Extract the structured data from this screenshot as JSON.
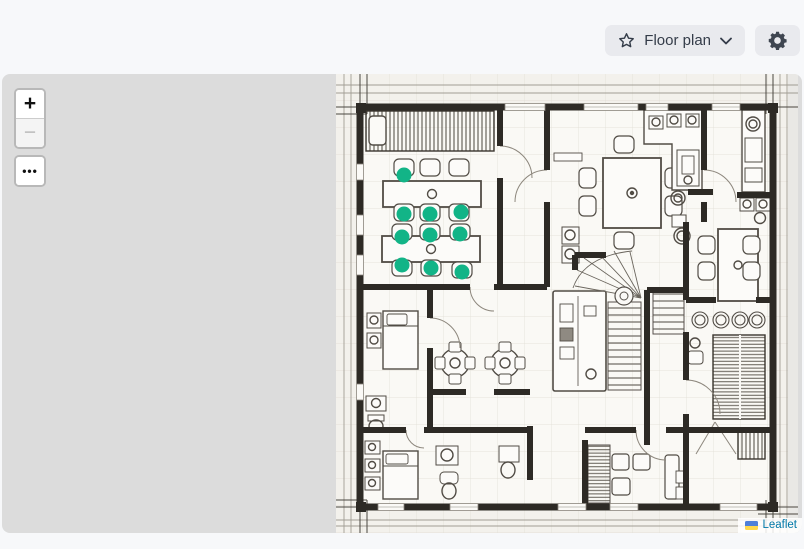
{
  "header": {
    "floor_plan_button": {
      "label": "Floor plan",
      "icons": [
        "star-outline-icon",
        "chevron-down-icon"
      ]
    },
    "settings_button": {
      "icon": "gear-icon"
    }
  },
  "map": {
    "controls": {
      "zoom_in": "+",
      "zoom_out": "−",
      "more": "•••"
    },
    "attribution": {
      "label": "Leaflet",
      "icon": "ukraine-flag-icon"
    },
    "layer_name": "Floor plan",
    "markers": [
      {
        "x": 68,
        "y": 101
      },
      {
        "x": 68,
        "y": 140
      },
      {
        "x": 94,
        "y": 140
      },
      {
        "x": 125,
        "y": 138
      },
      {
        "x": 66,
        "y": 163
      },
      {
        "x": 94,
        "y": 161
      },
      {
        "x": 124,
        "y": 160
      },
      {
        "x": 66,
        "y": 191
      },
      {
        "x": 95,
        "y": 194
      },
      {
        "x": 126,
        "y": 198
      }
    ]
  },
  "colors": {
    "marker": "#12b487",
    "leaflet_link": "#0078a8",
    "map_bg": "#dcdcdc",
    "wall": "#2d2a25",
    "paper": "#f3f1ec",
    "button_bg": "#e9eaee",
    "button_text": "#343c49",
    "flag_blue": "#4f80da",
    "flag_yellow": "#ffd84d"
  }
}
